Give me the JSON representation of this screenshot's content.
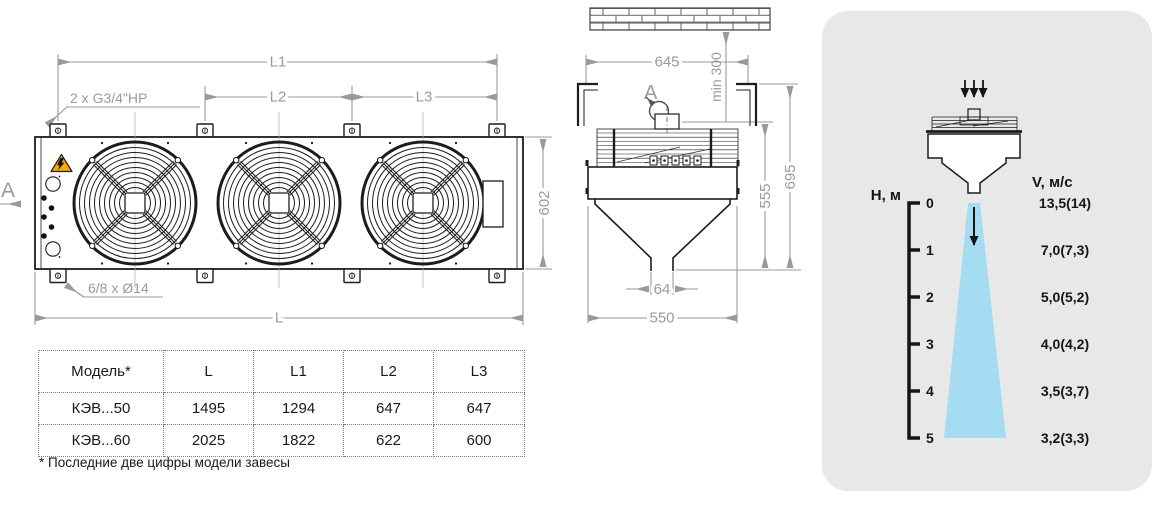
{
  "front_view": {
    "section_label": "A",
    "pipe_note": "2 x G3/4\"HP",
    "holes_note": "6/8 x Ø14",
    "dims": {
      "l1": "L1",
      "l2": "L2",
      "l3": "L3",
      "l": "L",
      "height": "602"
    }
  },
  "side_view": {
    "view_label": "A",
    "dims": {
      "width": "645",
      "wall_gap": "min 300",
      "h_unit": "555",
      "h_total": "695",
      "nozzle": "64",
      "depth": "550"
    }
  },
  "airflow_panel": {
    "h_axis_label": "H, м",
    "v_axis_label": "V, м/с",
    "heights": [
      "0",
      "1",
      "2",
      "3",
      "4",
      "5"
    ],
    "velocities": [
      "13,5(14)",
      "7,0(7,3)",
      "5,0(5,2)",
      "4,0(4,2)",
      "3,5(3,7)",
      "3,2(3,3)"
    ]
  },
  "table": {
    "headers": [
      "Модель*",
      "L",
      "L1",
      "L2",
      "L3"
    ],
    "rows": [
      [
        "КЭВ...50",
        "1495",
        "1294",
        "647",
        "647"
      ],
      [
        "КЭВ...60",
        "2025",
        "1822",
        "622",
        "600"
      ]
    ],
    "footnote": "* Последние две цифры модели завесы"
  },
  "colors": {
    "panel_bg": "#e8e8e8",
    "jet": "#a6dcf2",
    "dim": "#9a9a9a",
    "warning": "#f6a800"
  }
}
